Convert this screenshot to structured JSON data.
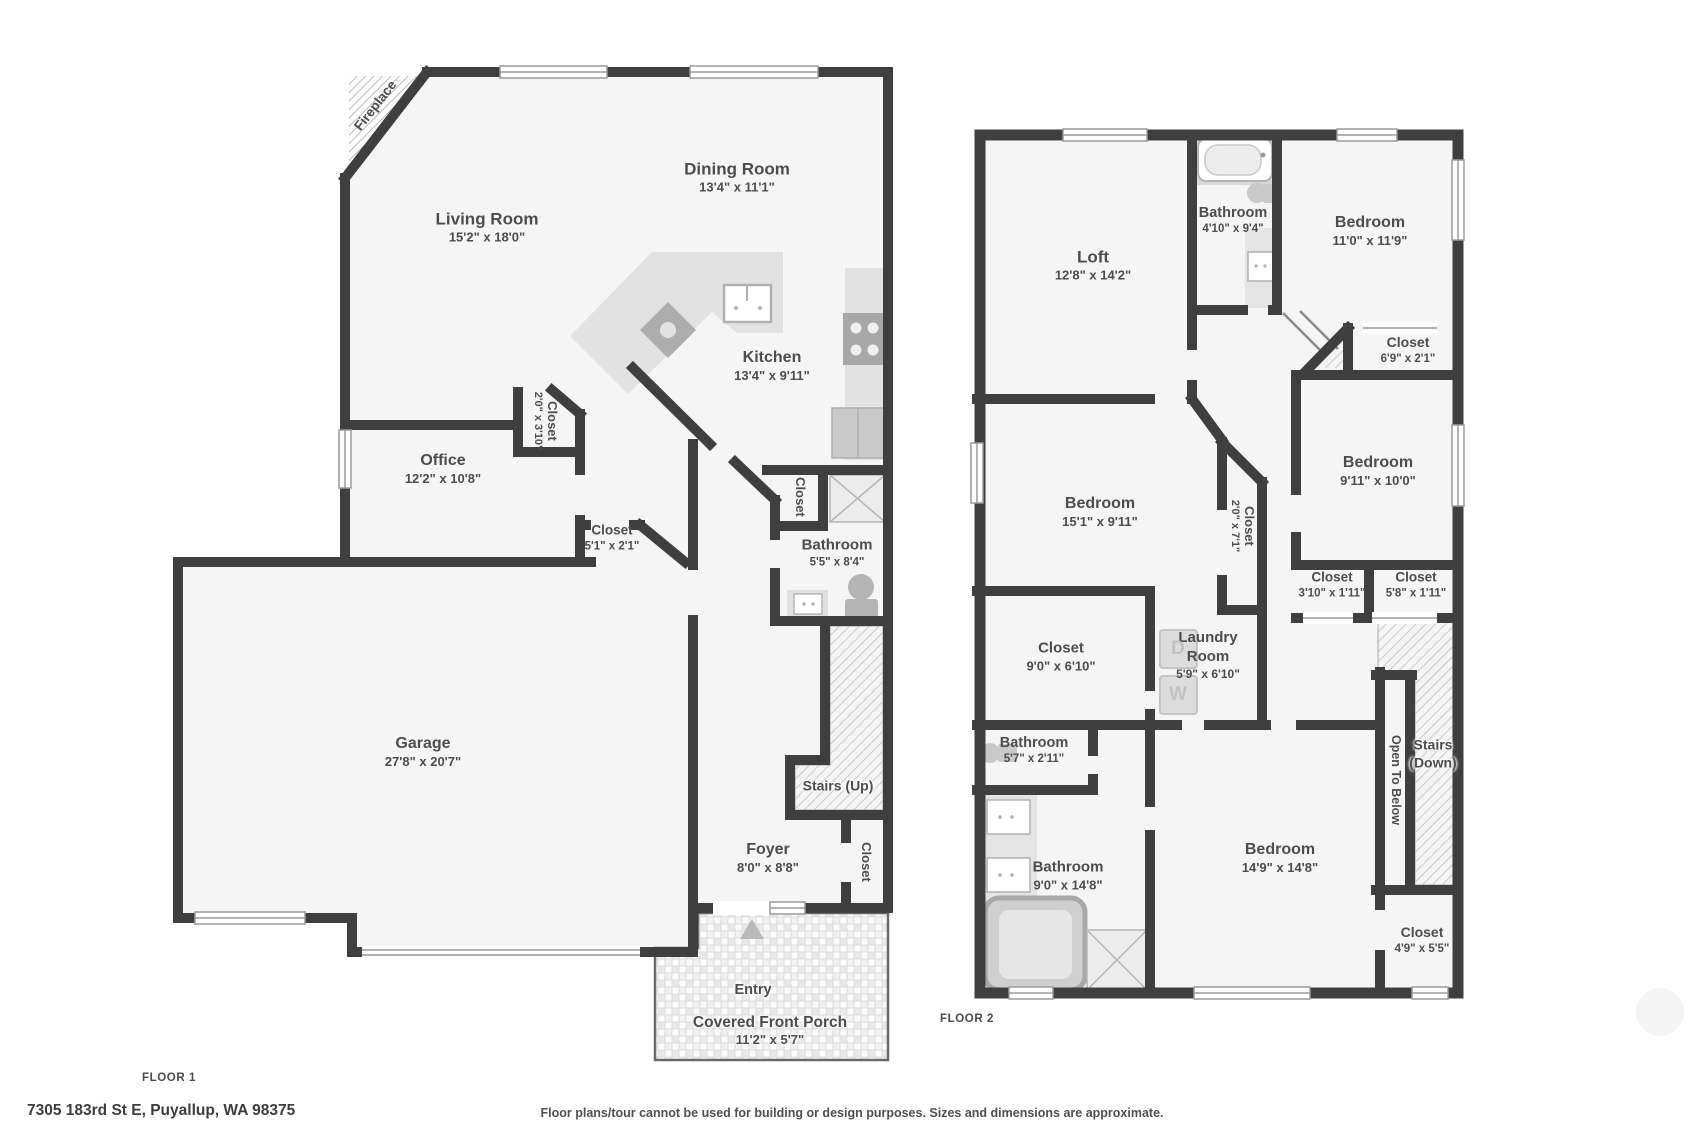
{
  "page": {
    "floor1_label": "FLOOR 1",
    "floor2_label": "FLOOR 2",
    "address": "7305 183rd St E, Puyallup, WA 98375",
    "disclaimer": "Floor plans/tour cannot be used for building or design purposes. Sizes and dimensions are approximate."
  },
  "floor1": {
    "fireplace": "Fireplace",
    "living_room": {
      "name": "Living Room",
      "dims": "15'2\" x 18'0\""
    },
    "dining_room": {
      "name": "Dining Room",
      "dims": "13'4\" x 11'1\""
    },
    "kitchen": {
      "name": "Kitchen",
      "dims": "13'4\" x 9'11\""
    },
    "office": {
      "name": "Office",
      "dims": "12'2\" x 10'8\""
    },
    "office_closet": {
      "name": "Closet",
      "dims": "2'0\" x 3'10\""
    },
    "hall_closet": {
      "name": "Closet",
      "dims": "5'1\" x 2'1\""
    },
    "bath_closet": {
      "name": "Closet"
    },
    "bathroom": {
      "name": "Bathroom",
      "dims": "5'5\" x 8'4\""
    },
    "garage": {
      "name": "Garage",
      "dims": "27'8\" x 20'7\""
    },
    "stairs_up": {
      "name": "Stairs (Up)"
    },
    "foyer": {
      "name": "Foyer",
      "dims": "8'0\" x 8'8\""
    },
    "foyer_closet": {
      "name": "Closet"
    },
    "entry": {
      "name": "Entry"
    },
    "porch": {
      "name": "Covered Front Porch",
      "dims": "11'2\" x 5'7\""
    }
  },
  "floor2": {
    "loft": {
      "name": "Loft",
      "dims": "12'8\" x 14'2\""
    },
    "bathroom_top": {
      "name": "Bathroom",
      "dims": "4'10\" x 9'4\""
    },
    "bedroom_top": {
      "name": "Bedroom",
      "dims": "11'0\" x 11'9\""
    },
    "closet_69": {
      "name": "Closet",
      "dims": "6'9\" x 2'1\""
    },
    "bedroom_mid_left": {
      "name": "Bedroom",
      "dims": "15'1\" x 9'11\""
    },
    "closet_20": {
      "name": "Closet",
      "dims": "2'0\" x 7'1\""
    },
    "bedroom_mid_right": {
      "name": "Bedroom",
      "dims": "9'11\" x 10'0\""
    },
    "closet_310": {
      "name": "Closet",
      "dims": "3'10\" x 1'11\""
    },
    "closet_58": {
      "name": "Closet",
      "dims": "5'8\" x 1'11\""
    },
    "closet_90": {
      "name": "Closet",
      "dims": "9'0\" x 6'10\""
    },
    "laundry": {
      "name_line1": "Laundry",
      "name_line2": "Room",
      "dims": "5'9\" x 6'10\""
    },
    "bathroom_57": {
      "name": "Bathroom",
      "dims": "5'7\" x 2'11\""
    },
    "bathroom_90": {
      "name": "Bathroom",
      "dims": "9'0\" x 14'8\""
    },
    "bedroom_bottom": {
      "name": "Bedroom",
      "dims": "14'9\" x 14'8\""
    },
    "open_to_below": {
      "name": "Open To Below"
    },
    "stairs_down": {
      "name_line1": "Stairs",
      "name_line2": "(Down)"
    },
    "closet_49": {
      "name": "Closet",
      "dims": "4'9\" x 5'5\""
    },
    "washer": "W",
    "dryer": "D"
  },
  "colors": {
    "wall": "#3f3f3f",
    "floor_fill": "#f5f5f5",
    "fixture_gray": "#e2e2e2",
    "appliance_gray": "#a8a8a8",
    "text": "#4d4d4d"
  }
}
